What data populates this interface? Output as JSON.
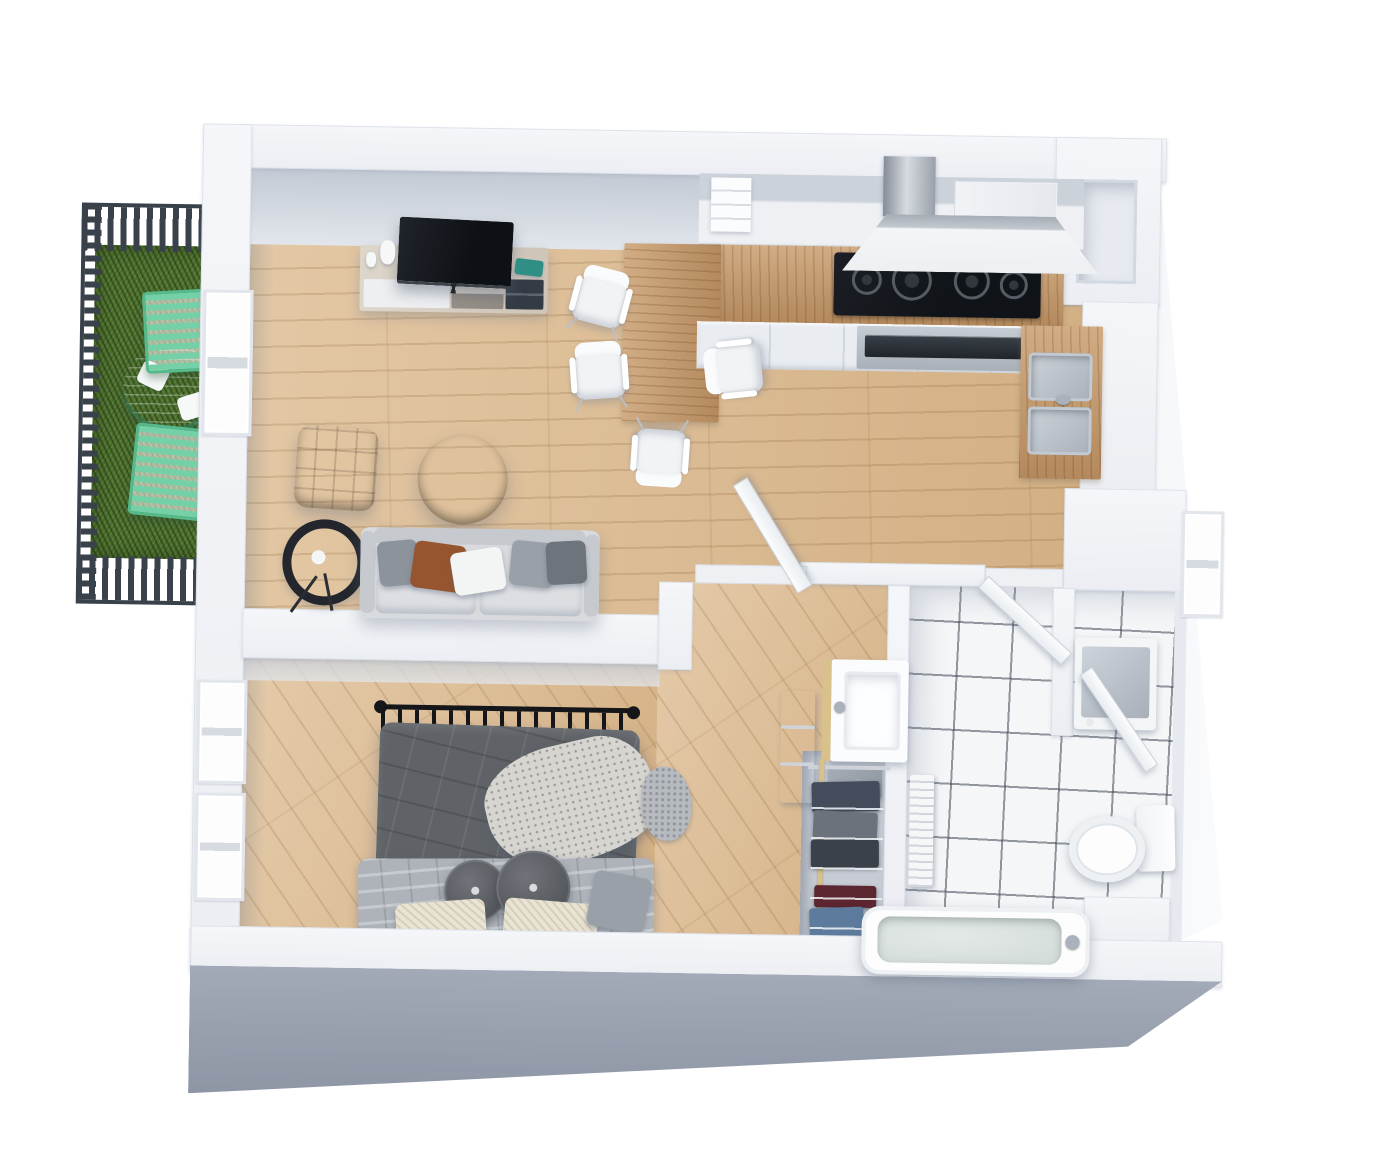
{
  "scene": {
    "name": "apartment-3d-floor-plan",
    "view": "isometric top-down 3D render",
    "background": "#ffffff"
  },
  "palette": {
    "bg": "#ffffff",
    "wall_top": "#f4f6f9",
    "wall_face": "#c2c9d3",
    "wall_front": "#8e96a5",
    "floor_wood": "#d9b78c",
    "counter_wood": "#c2976a",
    "tile": "#f4f6f8",
    "grout": "#3f4752",
    "grass": "#4e7030",
    "fence": "#39414b",
    "mint": "#74d0a7",
    "mint_dark": "#56b98c",
    "sofa": "#d8dade",
    "sofa_dark": "#c6cacf",
    "pillow_cognac": "#96552f",
    "ottoman": "#6f4a33",
    "ottoman_dark": "#5e3d2a",
    "coffee_table": "#3e4756",
    "duvet": "#5f6367",
    "sheet": "#aeb3ba",
    "pillow_cream": "#e9e3d3",
    "headboard": "#14161a",
    "tv": "#15181d",
    "steel": "#b8bec6",
    "teal": "#2f8f85",
    "denim": "#5d7b9d",
    "maroon": "#5c2630",
    "clothes_navy": "#424c5a",
    "clothes_gray": "#6b727b",
    "clothes_charcoal": "#3b414a",
    "pole": "#d9c18b"
  },
  "rooms": [
    {
      "id": "balcony",
      "label": "Balcony",
      "items": [
        "railing",
        "grass-lawn",
        "outdoor-table",
        "plates",
        "outdoor-chair",
        "outdoor-chair"
      ]
    },
    {
      "id": "living-room",
      "label": "Living room",
      "items": [
        "tv",
        "tv-console",
        "vase",
        "candle",
        "teal-box",
        "sofa",
        "throw-pillows",
        "ottoman",
        "coffee-table",
        "floor-lamp",
        "balcony-door"
      ]
    },
    {
      "id": "kitchen",
      "label": "Kitchen",
      "items": [
        "upper-cabinets",
        "open-shelf",
        "tall-cabinet",
        "range-hood",
        "cooktop",
        "oven",
        "base-cabinets",
        "dining-peninsula",
        "dining-chairs-x4",
        "sink-counter",
        "double-sink",
        "duct-shaft"
      ]
    },
    {
      "id": "bedroom",
      "label": "Bedroom",
      "items": [
        "metal-frame-bed",
        "duvet",
        "sheet",
        "throw-blanket",
        "round-pillows",
        "cream-pillows",
        "dresser",
        "rug",
        "window",
        "window"
      ]
    },
    {
      "id": "closet",
      "label": "Closet nook",
      "items": [
        "clothes-rack",
        "hanging-clothes",
        "shelf-box",
        "vanity-sink"
      ]
    },
    {
      "id": "bathroom",
      "label": "Bathroom",
      "items": [
        "tile-floor",
        "radiator",
        "toilet",
        "bathtub",
        "washing-machine",
        "door",
        "door",
        "door",
        "window"
      ]
    }
  ]
}
